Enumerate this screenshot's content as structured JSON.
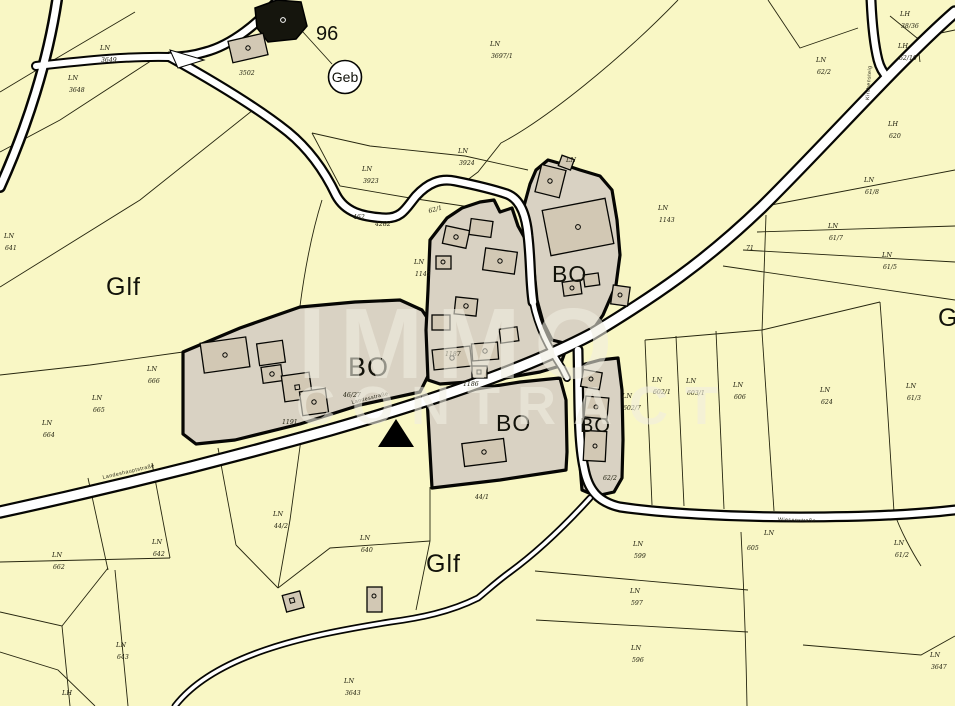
{
  "watermark": {
    "line1": "IMMO",
    "line2": "CONTRACT"
  },
  "poi": {
    "building_number": "96",
    "geb_label": "Geb"
  },
  "marker": {
    "type": "location-triangle",
    "color": "#000000"
  },
  "colors": {
    "background": "#f9f7c5",
    "zone_fill": "#d9d2c3",
    "building_fill": "#d2c8b4",
    "road_fill": "#ffffff",
    "line": "#26260f",
    "watermark": "#f1eee1"
  },
  "zone_labels": [
    {
      "text": "Glf",
      "x": 106,
      "y": 295,
      "size": 25
    },
    {
      "text": "Glf",
      "x": 426,
      "y": 572,
      "size": 25
    },
    {
      "text": "Glf",
      "x": 938,
      "y": 326,
      "size": 25
    },
    {
      "text": "BO",
      "x": 348,
      "y": 376,
      "size": 27
    },
    {
      "text": "BO",
      "x": 552,
      "y": 282,
      "size": 23
    },
    {
      "text": "BO",
      "x": 496,
      "y": 431,
      "size": 23
    },
    {
      "text": "BO",
      "x": 580,
      "y": 432,
      "size": 20
    }
  ],
  "road_names": [
    {
      "text": "Landeshauptstraße",
      "x": 103,
      "y": 479,
      "rot": -13
    },
    {
      "text": "Landesstraße",
      "x": 352,
      "y": 404,
      "rot": -14
    },
    {
      "text": "Wiesenstraße",
      "x": 778,
      "y": 521,
      "rot": 2
    },
    {
      "text": "Kirchensteig",
      "x": 869,
      "y": 100,
      "rot": -86
    }
  ],
  "parcel_labels": [
    {
      "t": "LN",
      "n": "3649",
      "x": 100,
      "y": 50
    },
    {
      "t": "LN",
      "n": "3648",
      "x": 68,
      "y": 80
    },
    {
      "t": "LN",
      "n": "641",
      "x": 4,
      "y": 238
    },
    {
      "t": "LN",
      "n": "3923",
      "x": 362,
      "y": 171
    },
    {
      "t": "LN",
      "n": "3924",
      "x": 458,
      "y": 153
    },
    {
      "t": "",
      "n": "462",
      "x": 352,
      "y": 207
    },
    {
      "t": "",
      "n": "4282",
      "x": 374,
      "y": 214
    },
    {
      "t": "",
      "n": "62/1",
      "x": 428,
      "y": 201,
      "rot": -15
    },
    {
      "t": "LN",
      "n": "3697/1",
      "x": 490,
      "y": 46
    },
    {
      "t": "LN",
      "n": "1143",
      "x": 658,
      "y": 210
    },
    {
      "t": "LN",
      "n": "62/2",
      "x": 816,
      "y": 62
    },
    {
      "t": "LH",
      "n": "38/36",
      "x": 900,
      "y": 16
    },
    {
      "t": "LH",
      "n": "62/10",
      "x": 898,
      "y": 48
    },
    {
      "t": "LH",
      "n": "620",
      "x": 888,
      "y": 126
    },
    {
      "t": "LN",
      "n": "61/8",
      "x": 864,
      "y": 182
    },
    {
      "t": "LN",
      "n": "61/7",
      "x": 828,
      "y": 228
    },
    {
      "t": "",
      "n": "71",
      "x": 745,
      "y": 238
    },
    {
      "t": "LN",
      "n": "61/5",
      "x": 882,
      "y": 257
    },
    {
      "t": "LN",
      "n": "61/3",
      "x": 906,
      "y": 388
    },
    {
      "t": "LN",
      "n": "1145",
      "x": 414,
      "y": 264
    },
    {
      "t": "LN",
      "n": "",
      "x": 566,
      "y": 162
    },
    {
      "t": "",
      "n": "1187",
      "x": 444,
      "y": 344
    },
    {
      "t": "",
      "n": "1186",
      "x": 462,
      "y": 374
    },
    {
      "t": "",
      "n": "46/27",
      "x": 342,
      "y": 385
    },
    {
      "t": "",
      "n": "1191",
      "x": 281,
      "y": 412
    },
    {
      "t": "",
      "n": "62/2",
      "x": 602,
      "y": 468
    },
    {
      "t": "",
      "n": "44/1",
      "x": 474,
      "y": 487
    },
    {
      "t": "LN",
      "n": "44/2",
      "x": 273,
      "y": 516
    },
    {
      "t": "LN",
      "n": "664",
      "x": 42,
      "y": 425
    },
    {
      "t": "LN",
      "n": "665",
      "x": 92,
      "y": 400
    },
    {
      "t": "LN",
      "n": "666",
      "x": 147,
      "y": 371
    },
    {
      "t": "LN",
      "n": "662",
      "x": 52,
      "y": 557
    },
    {
      "t": "LN",
      "n": "642",
      "x": 152,
      "y": 544
    },
    {
      "t": "LN",
      "n": "640",
      "x": 360,
      "y": 540
    },
    {
      "t": "LN",
      "n": "643",
      "x": 116,
      "y": 647
    },
    {
      "t": "LN",
      "n": "3643",
      "x": 344,
      "y": 683
    },
    {
      "t": "LN",
      "n": "602/7",
      "x": 622,
      "y": 398
    },
    {
      "t": "LN",
      "n": "602/1",
      "x": 652,
      "y": 382
    },
    {
      "t": "LN",
      "n": "603/1",
      "x": 686,
      "y": 383
    },
    {
      "t": "LN",
      "n": "606",
      "x": 733,
      "y": 387
    },
    {
      "t": "LN",
      "n": "624",
      "x": 820,
      "y": 392
    },
    {
      "t": "",
      "n": "605",
      "x": 746,
      "y": 538
    },
    {
      "t": "LN",
      "n": "",
      "x": 764,
      "y": 535
    },
    {
      "t": "LN",
      "n": "61/2",
      "x": 894,
      "y": 545
    },
    {
      "t": "LN",
      "n": "599",
      "x": 633,
      "y": 546
    },
    {
      "t": "LN",
      "n": "597",
      "x": 630,
      "y": 593
    },
    {
      "t": "LN",
      "n": "596",
      "x": 631,
      "y": 650
    },
    {
      "t": "LN",
      "n": "3647",
      "x": 930,
      "y": 657
    },
    {
      "t": "",
      "n": "3502",
      "x": 238,
      "y": 63
    },
    {
      "t": "LH",
      "n": "",
      "x": 62,
      "y": 695
    }
  ]
}
